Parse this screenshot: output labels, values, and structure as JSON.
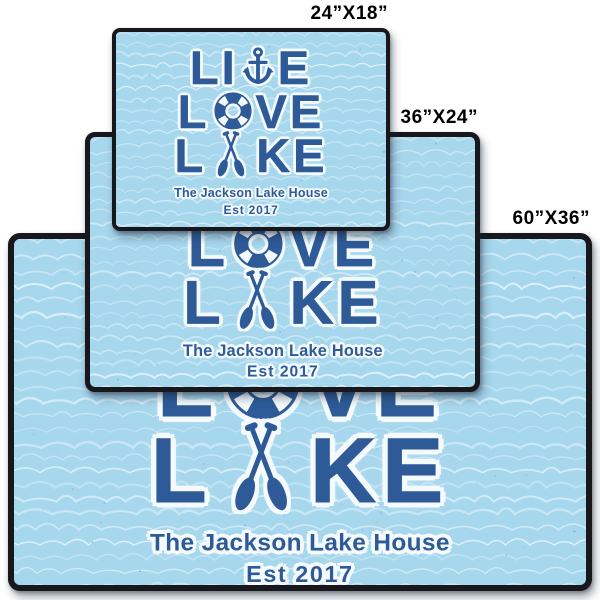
{
  "colors": {
    "page_bg": "#ffffff",
    "mat_bg": "#a7d7ed",
    "wave_light": "#cbe9f6",
    "wave_faint": "#ddf1fa",
    "wave_speckle": "#5d9fc6",
    "design_blue": "#2e5b98",
    "design_outline": "#f4fafd",
    "mat_border": "#17171c",
    "label_text": "#000000"
  },
  "design": {
    "lines": [
      {
        "word": "LIVE",
        "pre": "LI",
        "icon": "anchor-icon",
        "post": "E"
      },
      {
        "word": "LOVE",
        "pre": "L",
        "icon": "life-ring-icon",
        "post": "VE"
      },
      {
        "word": "LAKE",
        "pre": "L",
        "icon": "crossed-oars-icon",
        "post": "KE"
      }
    ],
    "caption_line1": "The Jackson Lake House",
    "caption_line2": "Est 2017"
  },
  "mats": [
    {
      "id": "doormat-60x36",
      "size_label": "60”X36”"
    },
    {
      "id": "doormat-36x24",
      "size_label": "36”X24”"
    },
    {
      "id": "doormat-24x18",
      "size_label": "24”X18”"
    }
  ]
}
